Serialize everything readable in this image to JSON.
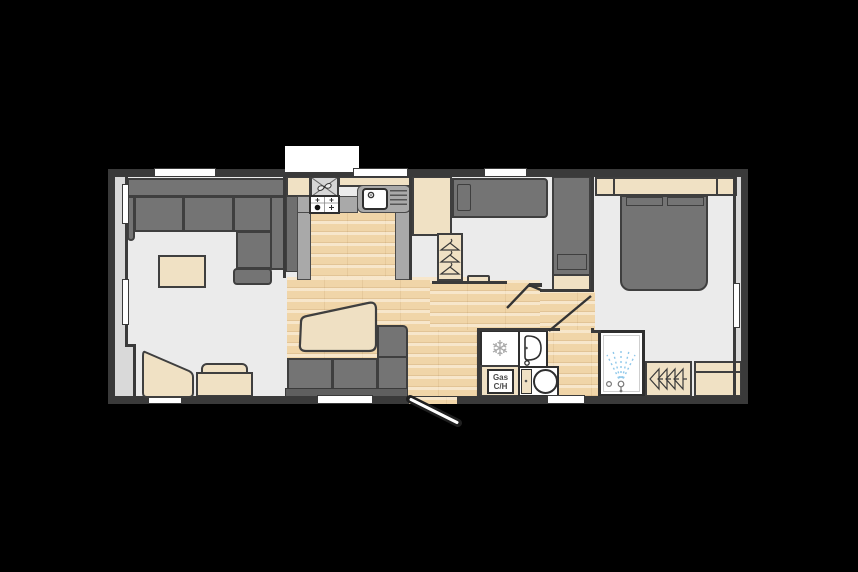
{
  "plan": {
    "kind": "static-caravan-floorplan",
    "background": "#000000"
  },
  "labels": {
    "gas_heater_line1": "Gas",
    "gas_heater_line2": "C/H"
  },
  "icons": {
    "snowflake_char": "❄",
    "extractor_fan": "extractor-fan-with-cross-braces",
    "hob": "four-burner-gas-hob",
    "sink": "sink-with-drainer-and-tap",
    "wardrobe_hangers_front": "three-clothes-hangers",
    "wardrobe_hangers_side": "four-clothes-hangers-sideways",
    "shower_spray": "shower-spray-jets",
    "washbasin": "washbasin-with-tap",
    "toilet": "toilet-with-cistern",
    "entrance_door": "open-door-leaf",
    "interior_doors": "door-swing-lines"
  },
  "colors": {
    "background": "#000000",
    "walls": "#3a3a3a",
    "floor": "#ebebeb",
    "wood_floor": "#f0d5a8",
    "upholstery_gray": "#747474",
    "furniture_cream": "#f0e1c4",
    "counter_gray": "#a9a9a9",
    "exterior_band": "#d9d9d9",
    "spray_blue": "#8fc8ea",
    "fixture_white": "#ffffff"
  }
}
